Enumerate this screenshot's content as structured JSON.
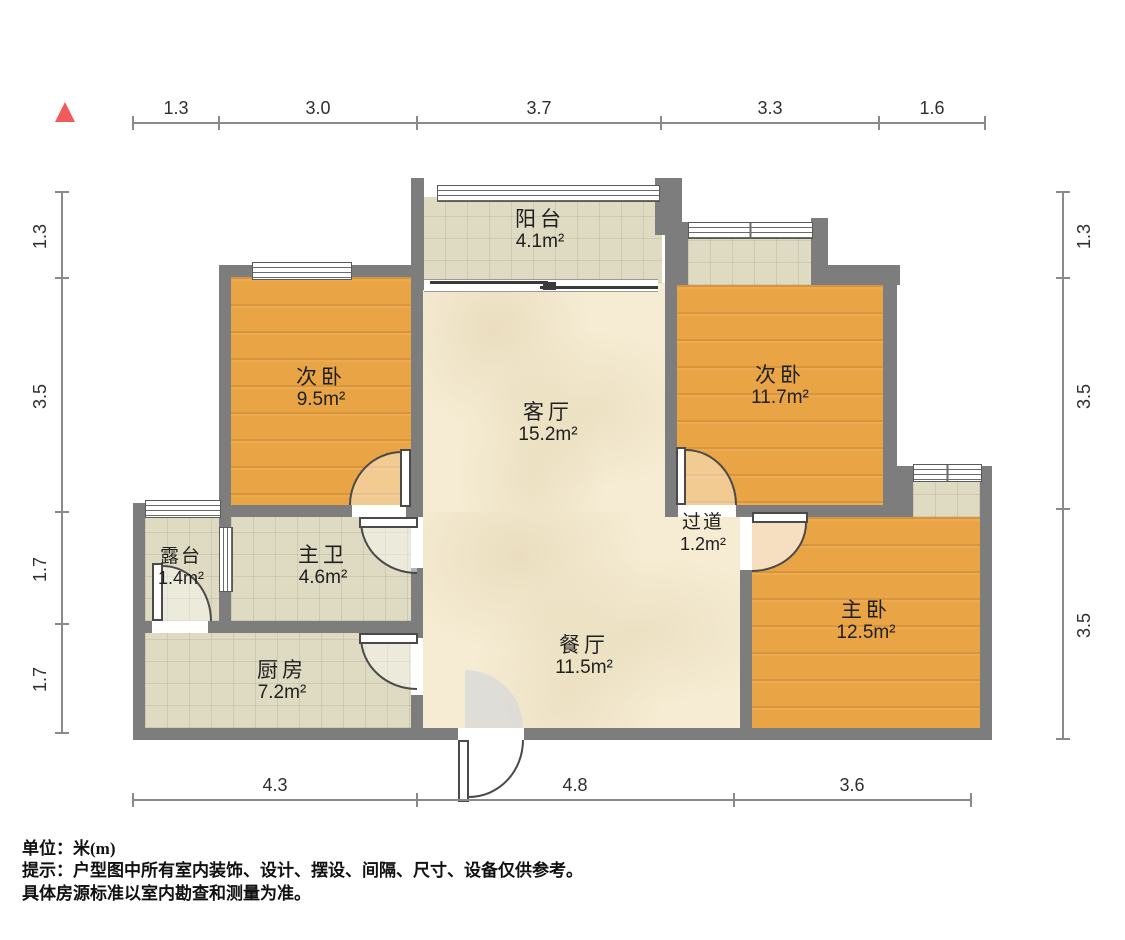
{
  "north_marker": {
    "color": "#f2595b",
    "shape": "triangle-up"
  },
  "rooms": [
    {
      "id": "balcony",
      "name": "阳台",
      "area": "4.1m²"
    },
    {
      "id": "bedroom-left",
      "name": "次卧",
      "area": "9.5m²"
    },
    {
      "id": "living",
      "name": "客厅",
      "area": "15.2m²"
    },
    {
      "id": "bedroom-right",
      "name": "次卧",
      "area": "11.7m²"
    },
    {
      "id": "terrace",
      "name": "露台",
      "area": "1.4m²"
    },
    {
      "id": "bathroom",
      "name": "主卫",
      "area": "4.6m²"
    },
    {
      "id": "hallway",
      "name": "过道",
      "area": "1.2m²"
    },
    {
      "id": "master",
      "name": "主卧",
      "area": "12.5m²"
    },
    {
      "id": "kitchen",
      "name": "厨房",
      "area": "7.2m²"
    },
    {
      "id": "dining",
      "name": "餐厅",
      "area": "11.5m²"
    }
  ],
  "dimensions": {
    "top": [
      "1.3",
      "3.0",
      "3.7",
      "3.3",
      "1.6"
    ],
    "left": [
      "1.3",
      "3.5",
      "1.7",
      "1.7"
    ],
    "right": [
      "1.3",
      "3.5",
      "3.5"
    ],
    "bottom": [
      "4.3",
      "4.8",
      "3.6"
    ]
  },
  "footer": {
    "unit_line": "单位：米(m)",
    "tip_line": "提示：户型图中所有室内装饰、设计、摆设、间隔、尺寸、设备仅供参考。",
    "tip_line2": "具体房源标准以室内勘查和测量为准。"
  },
  "colors": {
    "wall": "#7d7d7d",
    "wood_floor": "#e9a545",
    "tile_floor": "#dfdbc2",
    "marble_floor": "#f5ecd3",
    "door_swing_peach": "#f6dfc0",
    "dimension_line": "#8a8a8a"
  }
}
